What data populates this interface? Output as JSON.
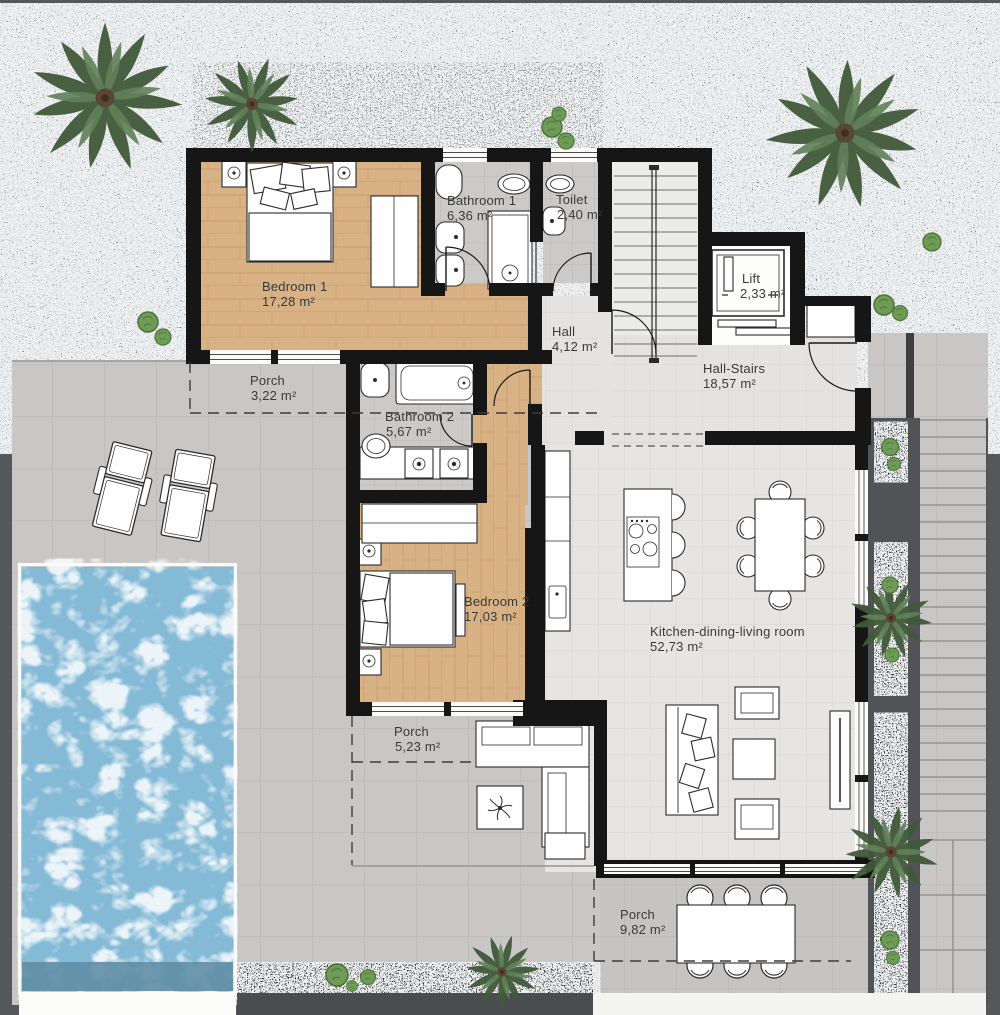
{
  "plan_title": "Villa first floor plan",
  "rooms": [
    {
      "id": "bedroom-1",
      "name": "Bedroom 1",
      "area": "17,28 m²"
    },
    {
      "id": "bathroom-1",
      "name": "Bathroom 1",
      "area": "6,36 m²"
    },
    {
      "id": "toilet",
      "name": "Toilet",
      "area": "2,40 m²"
    },
    {
      "id": "hall",
      "name": "Hall",
      "area": "4,12 m²"
    },
    {
      "id": "lift",
      "name": "Lift",
      "area": "2,33 m²"
    },
    {
      "id": "hall-stairs",
      "name": "Hall-Stairs",
      "area": "18,57 m²"
    },
    {
      "id": "porch-north",
      "name": "Porch",
      "area": "3,22 m²"
    },
    {
      "id": "bathroom-2",
      "name": "Bathroom 2",
      "area": "5,67 m²"
    },
    {
      "id": "bedroom-2",
      "name": "Bedroom 2",
      "area": "17,03 m²"
    },
    {
      "id": "kitchen-dining-living",
      "name": "Kitchen-dining-living room",
      "area": "52,73 m²"
    },
    {
      "id": "porch-west",
      "name": "Porch",
      "area": "5,23 m²"
    },
    {
      "id": "porch-south",
      "name": "Porch",
      "area": "9,82 m²"
    }
  ],
  "palette": {
    "wall": "#161616",
    "wood_floor": "#d8b185",
    "interior_tile": "#e6e5e3",
    "bath_tile": "#cbcac8",
    "terrace_paving": "#c8c7c5",
    "gravel_dark": "#3a3c3f",
    "gravel_light": "#b2b5b7",
    "pool_water": "#85bad7",
    "plant_green": "#5d7a4d",
    "label_text": "#3a3a3a"
  }
}
